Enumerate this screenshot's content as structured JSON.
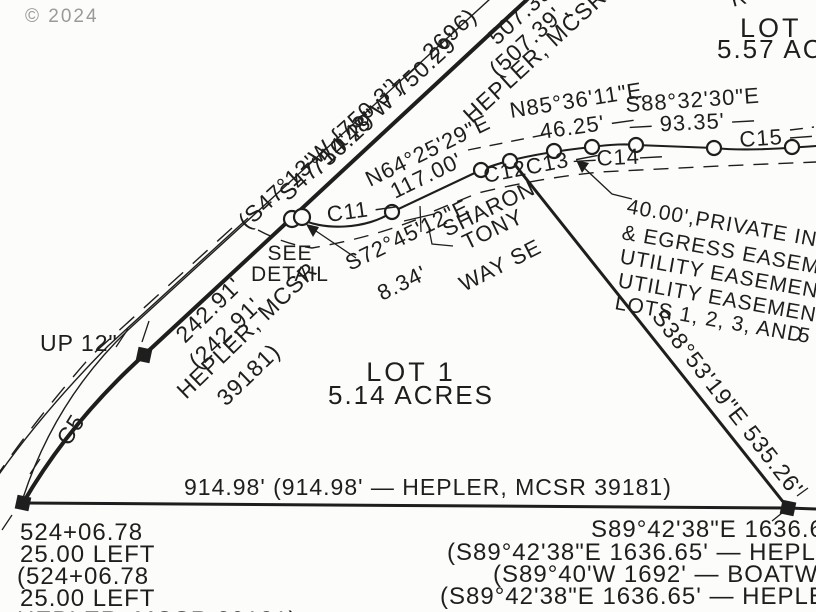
{
  "document": {
    "type": "survey-plat",
    "lot_shown": "LOT 1",
    "lot_area": "5.14 ACRES",
    "road_name": "SHARON TONY WAY SE"
  },
  "colors": {
    "ink": "#1e1e1e",
    "paper": "#fcfcfa",
    "watermark": "#9a9a9a"
  },
  "labels": {
    "watermark": "© 2024",
    "s47_bearing": "S47°14'48\"W 750.29'",
    "s47_record": "(S47°13'W {750.3'} — 2696)",
    "d750": "750.29'",
    "d507": "507.39'",
    "d507_record": "(507.39',",
    "hepler_top": "HEPLER, MCSR 3918",
    "top_right_partial": "R 5.",
    "lot2_title": "LOT",
    "lot2_acres": "5.57 ACR",
    "n85_bearing": "N85°36'11\"E",
    "n85_dist": "46.25' —",
    "s88_bearing": "S88°32'30\"E",
    "s88_dist": "— 93.35' —",
    "c15": "C15 —",
    "c14": "—C14—",
    "c12c13": "C12C13 —",
    "c11": "C11 —",
    "n64_bearing": "N64°25'29\"E",
    "n64_dist": "117.00'",
    "road_name_1": "SHARON",
    "road_name_2": "TONY",
    "road_name_3": "WAY SE",
    "see_detail_1": "SEE",
    "see_detail_2": "DETAIL",
    "s72_bearing": "S72°45'12\"E",
    "s72_dist": "8.34'",
    "easement_1": "40.00',PRIVATE ING",
    "easement_2": "& EGRESS EASEMEN",
    "easement_3": "UTILITY EASEMENT",
    "easement_4": "UTILITY EASEMENT F",
    "easement_5": "LOTS 1, 2, 3, AND",
    "s38_bearing": "S38°53'19\"E 535.26'",
    "right_edge_partial": "5",
    "d242": "242.91'",
    "d242_record": "(242.91'",
    "hepler_mid_1": "HEPLER, MCSR",
    "hepler_mid_2": "39181)",
    "up_pole": "UP  12\"",
    "c5": "C5",
    "lot1_title": "LOT 1",
    "lot1_acres": "5.14 ACRES",
    "south_dim": "914.98' (914.98' — HEPLER, MCSR 39181)",
    "station_1": "524+06.78",
    "station_2": "25.00 LEFT",
    "station_3": "(524+06.78",
    "station_4": "25.00 LEFT",
    "station_5": "HEPLER, MCSR 39181)",
    "east_dim_1": "S89°42'38\"E 1636.65",
    "east_dim_2": "(S89°42'38\"E 1636.65' — HEPLER,",
    "east_dim_3": "(S89°40'W 1692' — BOATWRIGH",
    "east_dim_4": "(S89°42'38\"E 1636.65' — HEPLER,"
  }
}
